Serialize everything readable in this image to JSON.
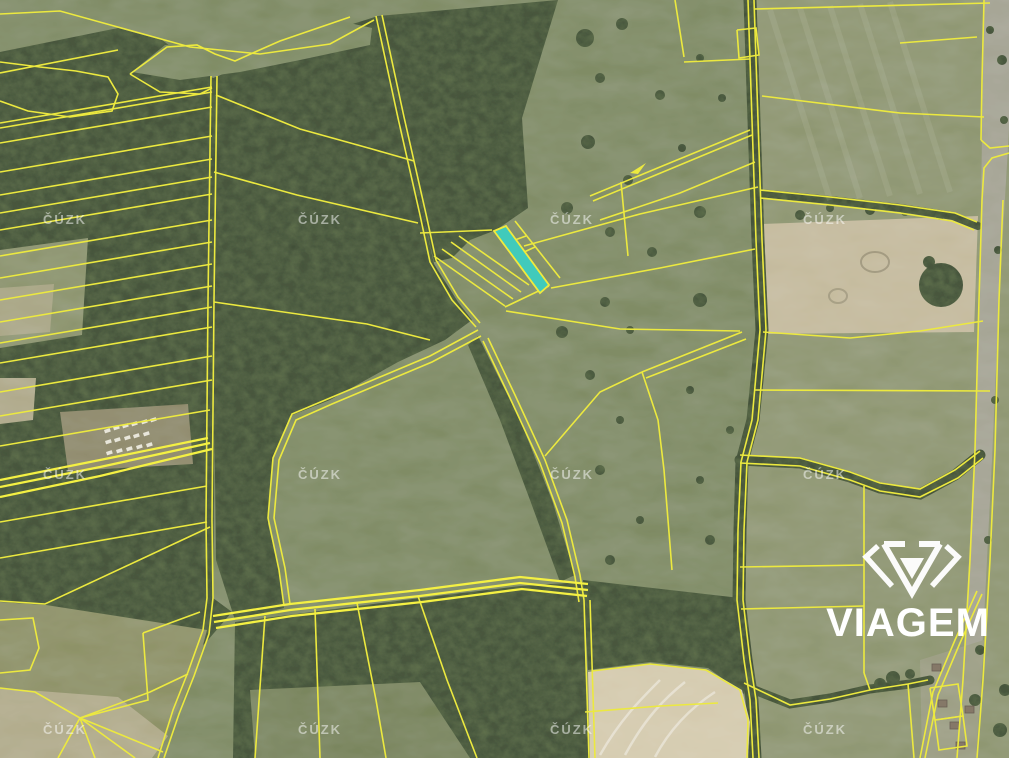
{
  "map": {
    "type": "aerial-cadastral-map",
    "provider_watermark": {
      "text": "ČÚZK",
      "color": "#ffffff",
      "opacity": 0.5,
      "grid_columns_x": [
        65,
        320,
        572,
        825
      ],
      "grid_rows_y": [
        219,
        474,
        729
      ]
    },
    "brand": {
      "name": "VIAGEM",
      "color": "#ffffff"
    },
    "highlighted_parcel": {
      "description": "narrow strip parcel highlighted on map",
      "fill": "#41cabb",
      "outline": "#f0ea3c"
    },
    "colors": {
      "parcel_line": "#ece93f",
      "parcel_line_bright": "#f4f043",
      "forest": "#48573e",
      "meadow": "#808c65",
      "field_light": "#8f9772",
      "field_beige_top": "#c5bb9e",
      "field_beige_bottom": "#d5cbaf",
      "road": "#a5a494",
      "village": "#9c9e83",
      "clearing": "#8f8a6b",
      "tree_band": "#44523a",
      "trailer_white": "#e8e6da",
      "house": "#857868"
    }
  }
}
